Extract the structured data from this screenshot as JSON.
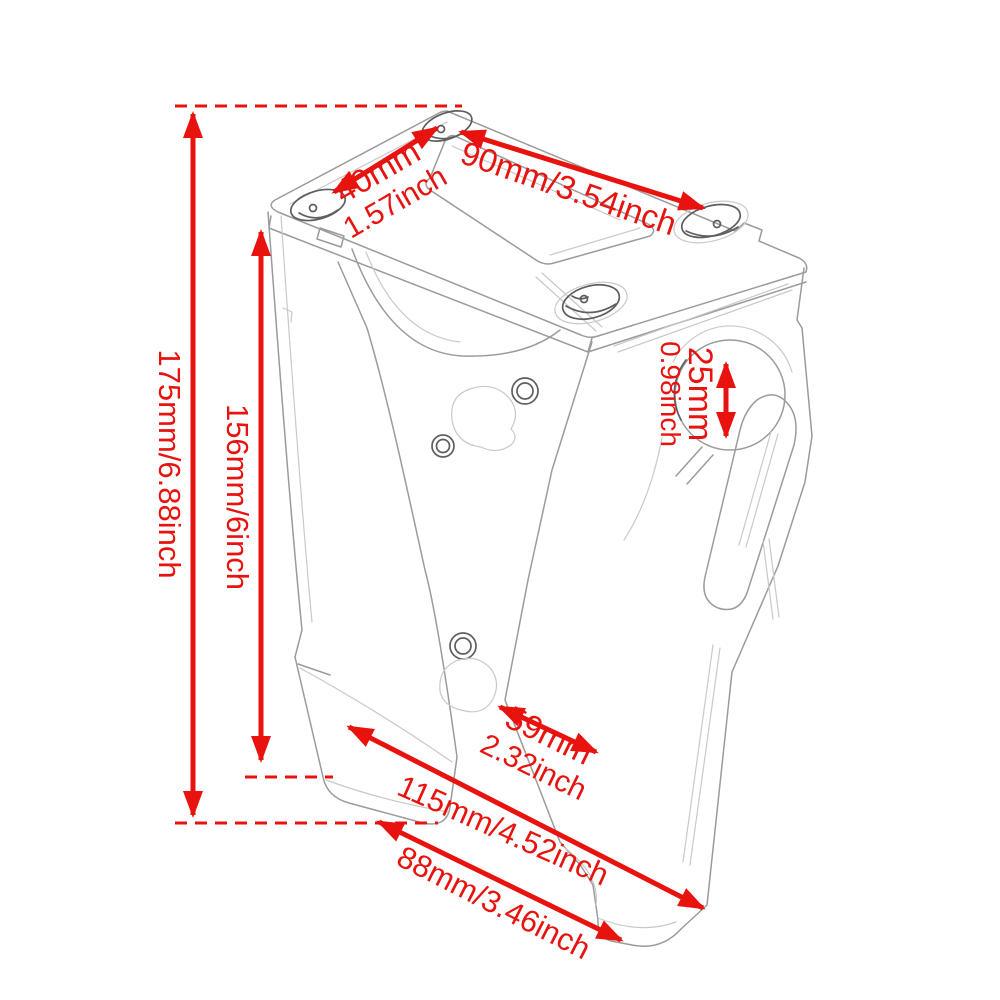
{
  "colors": {
    "annotation_red": "#e8130f",
    "sketch_gray": "#9b9b9b",
    "background": "#ffffff"
  },
  "annotations": {
    "total_height": {
      "text": "175mm/6.88inch"
    },
    "riser_height": {
      "text": "156mm/6inch"
    },
    "bolt_spacing": {
      "line1": "40mm",
      "line2": "1.57inch"
    },
    "top_width": {
      "text": "90mm/3.54inch"
    },
    "handlebar_diameter": {
      "line1": "25mm",
      "line2": "0.98inch"
    },
    "arm_width": {
      "line1": "59mm",
      "line2": "2.32inch"
    },
    "base_length": {
      "text": "115mm/4.52inch"
    },
    "base_width": {
      "text": "88mm/3.46inch"
    }
  }
}
